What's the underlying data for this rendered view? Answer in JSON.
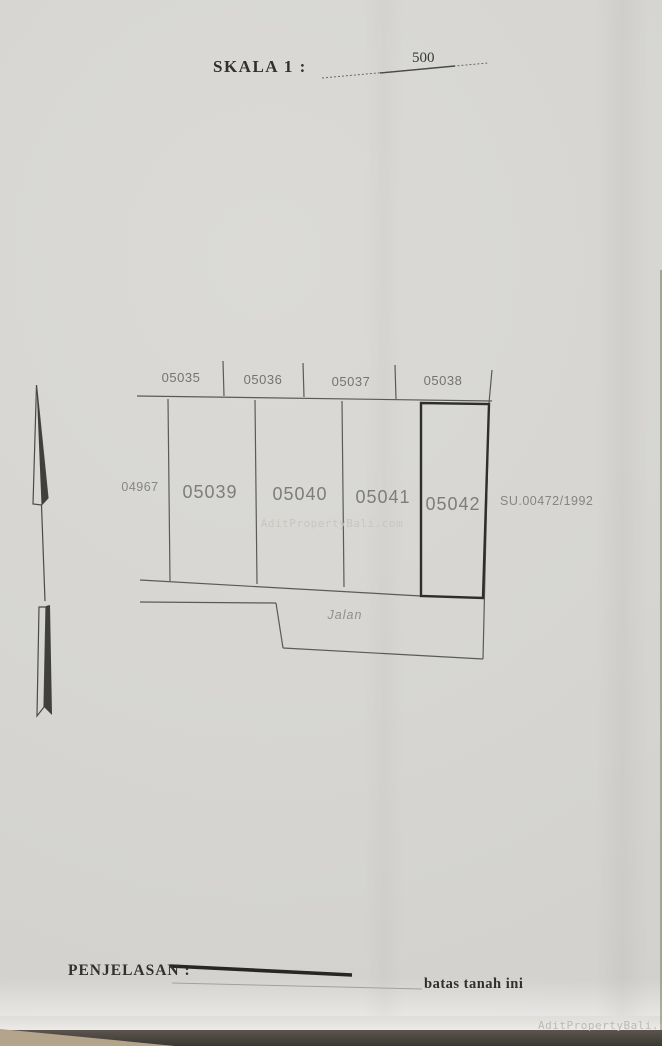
{
  "title": {
    "scale_label": "SKALA 1 :",
    "scale_value": "500"
  },
  "plan": {
    "adjacent_parcels_top": [
      "05035",
      "05036",
      "05037",
      "05038"
    ],
    "parcels": [
      "05039",
      "05040",
      "05041",
      "05042"
    ],
    "adjacent_parcel_left": "04967",
    "survey_ref": "SU.00472/1992",
    "road_label": "Jalan",
    "highlighted_parcel": "05042"
  },
  "legend": {
    "label": "PENJELASAN :",
    "line_caption": "batas tanah ini"
  },
  "watermark": {
    "text": "AditPropertyBali.com"
  },
  "colors": {
    "paper": "#d6d5d1",
    "ink_thin": "#5a5a58",
    "ink_bold": "#2e2e2c",
    "label_gray": "#7d7d7a",
    "watermark_gray": "#c7c6c1",
    "desk_strip": "#4a443e",
    "desk_corner_tan": "#b5a48c"
  }
}
